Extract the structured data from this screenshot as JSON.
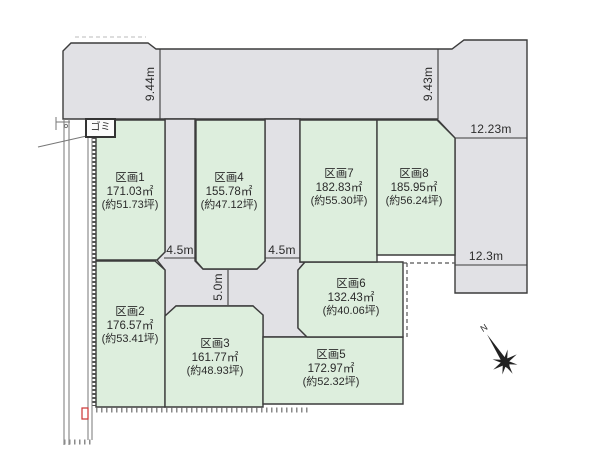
{
  "diagram_title": "land-lot-division-map",
  "colors": {
    "plot_fill": "#ddeedd",
    "road_fill": "#e1e1e5",
    "line": "#3c3c3c",
    "background": "#ffffff",
    "marker_red": "#cc3333",
    "hatch": "#8a8a8a"
  },
  "plots": [
    {
      "name": "区画1",
      "area_sqm": "171.03㎡",
      "area_tsubo": "(約51.73坪)"
    },
    {
      "name": "区画2",
      "area_sqm": "176.57㎡",
      "area_tsubo": "(約53.41坪)"
    },
    {
      "name": "区画3",
      "area_sqm": "161.77㎡",
      "area_tsubo": "(約48.93坪)"
    },
    {
      "name": "区画4",
      "area_sqm": "155.78㎡",
      "area_tsubo": "(約47.12坪)"
    },
    {
      "name": "区画5",
      "area_sqm": "172.97㎡",
      "area_tsubo": "(約52.32坪)"
    },
    {
      "name": "区画6",
      "area_sqm": "132.43㎡",
      "area_tsubo": "(約40.06坪)"
    },
    {
      "name": "区画7",
      "area_sqm": "182.83㎡",
      "area_tsubo": "(約55.30坪)"
    },
    {
      "name": "区画8",
      "area_sqm": "185.95㎡",
      "area_tsubo": "(約56.24坪)"
    }
  ],
  "measurements": {
    "top_left_depth": "9.44m",
    "top_right_depth": "9.43m",
    "right_upper_width": "12.23m",
    "right_lower_width": "12.3m",
    "road_west_width": "4.5m",
    "road_east_width": "4.5m",
    "road_south_width": "5.0m"
  },
  "labels": {
    "garbage_station": "ゴミ",
    "compass_north": "N"
  }
}
